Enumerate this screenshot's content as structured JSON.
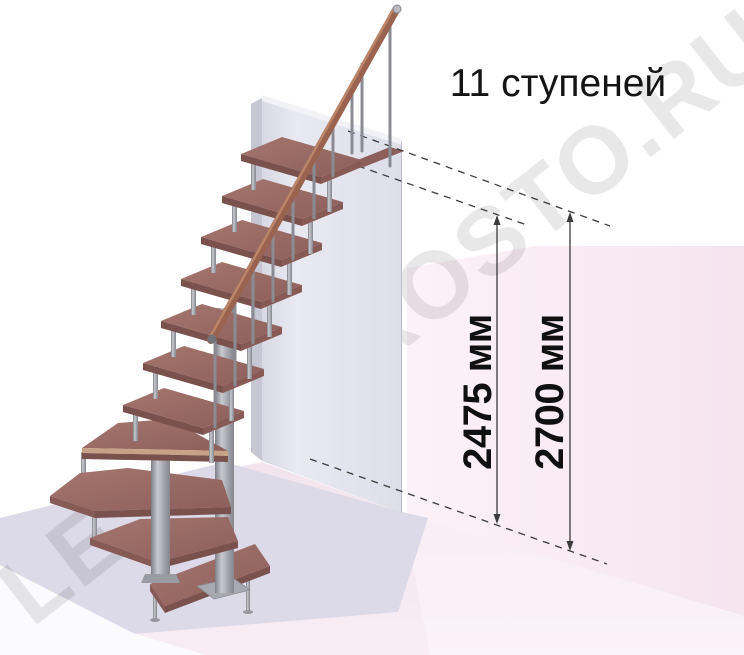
{
  "title": "11 ступеней",
  "stairs": {
    "step_count": "11"
  },
  "dimension_left": {
    "label": "2475 мм"
  },
  "dimension_right": {
    "label": "2700 мм"
  },
  "watermark": {
    "part1": "LE",
    "part2": "ROSTO.RU"
  },
  "colors": {
    "wood_tread": "#9b6f6a",
    "wood_rail": "#9a6350",
    "wood_edge_strip": "#c8a287",
    "metal": "#a2a2aa",
    "wall_gray": "#e4e4ed",
    "wall_pink": "#f8ebf3",
    "floor_pink": "#f3e7ef",
    "platform_gray": "#dcd9e8",
    "dimension_line": "#3b3b3b",
    "text": "#101010",
    "watermark_gray": "#e8e8e8"
  }
}
